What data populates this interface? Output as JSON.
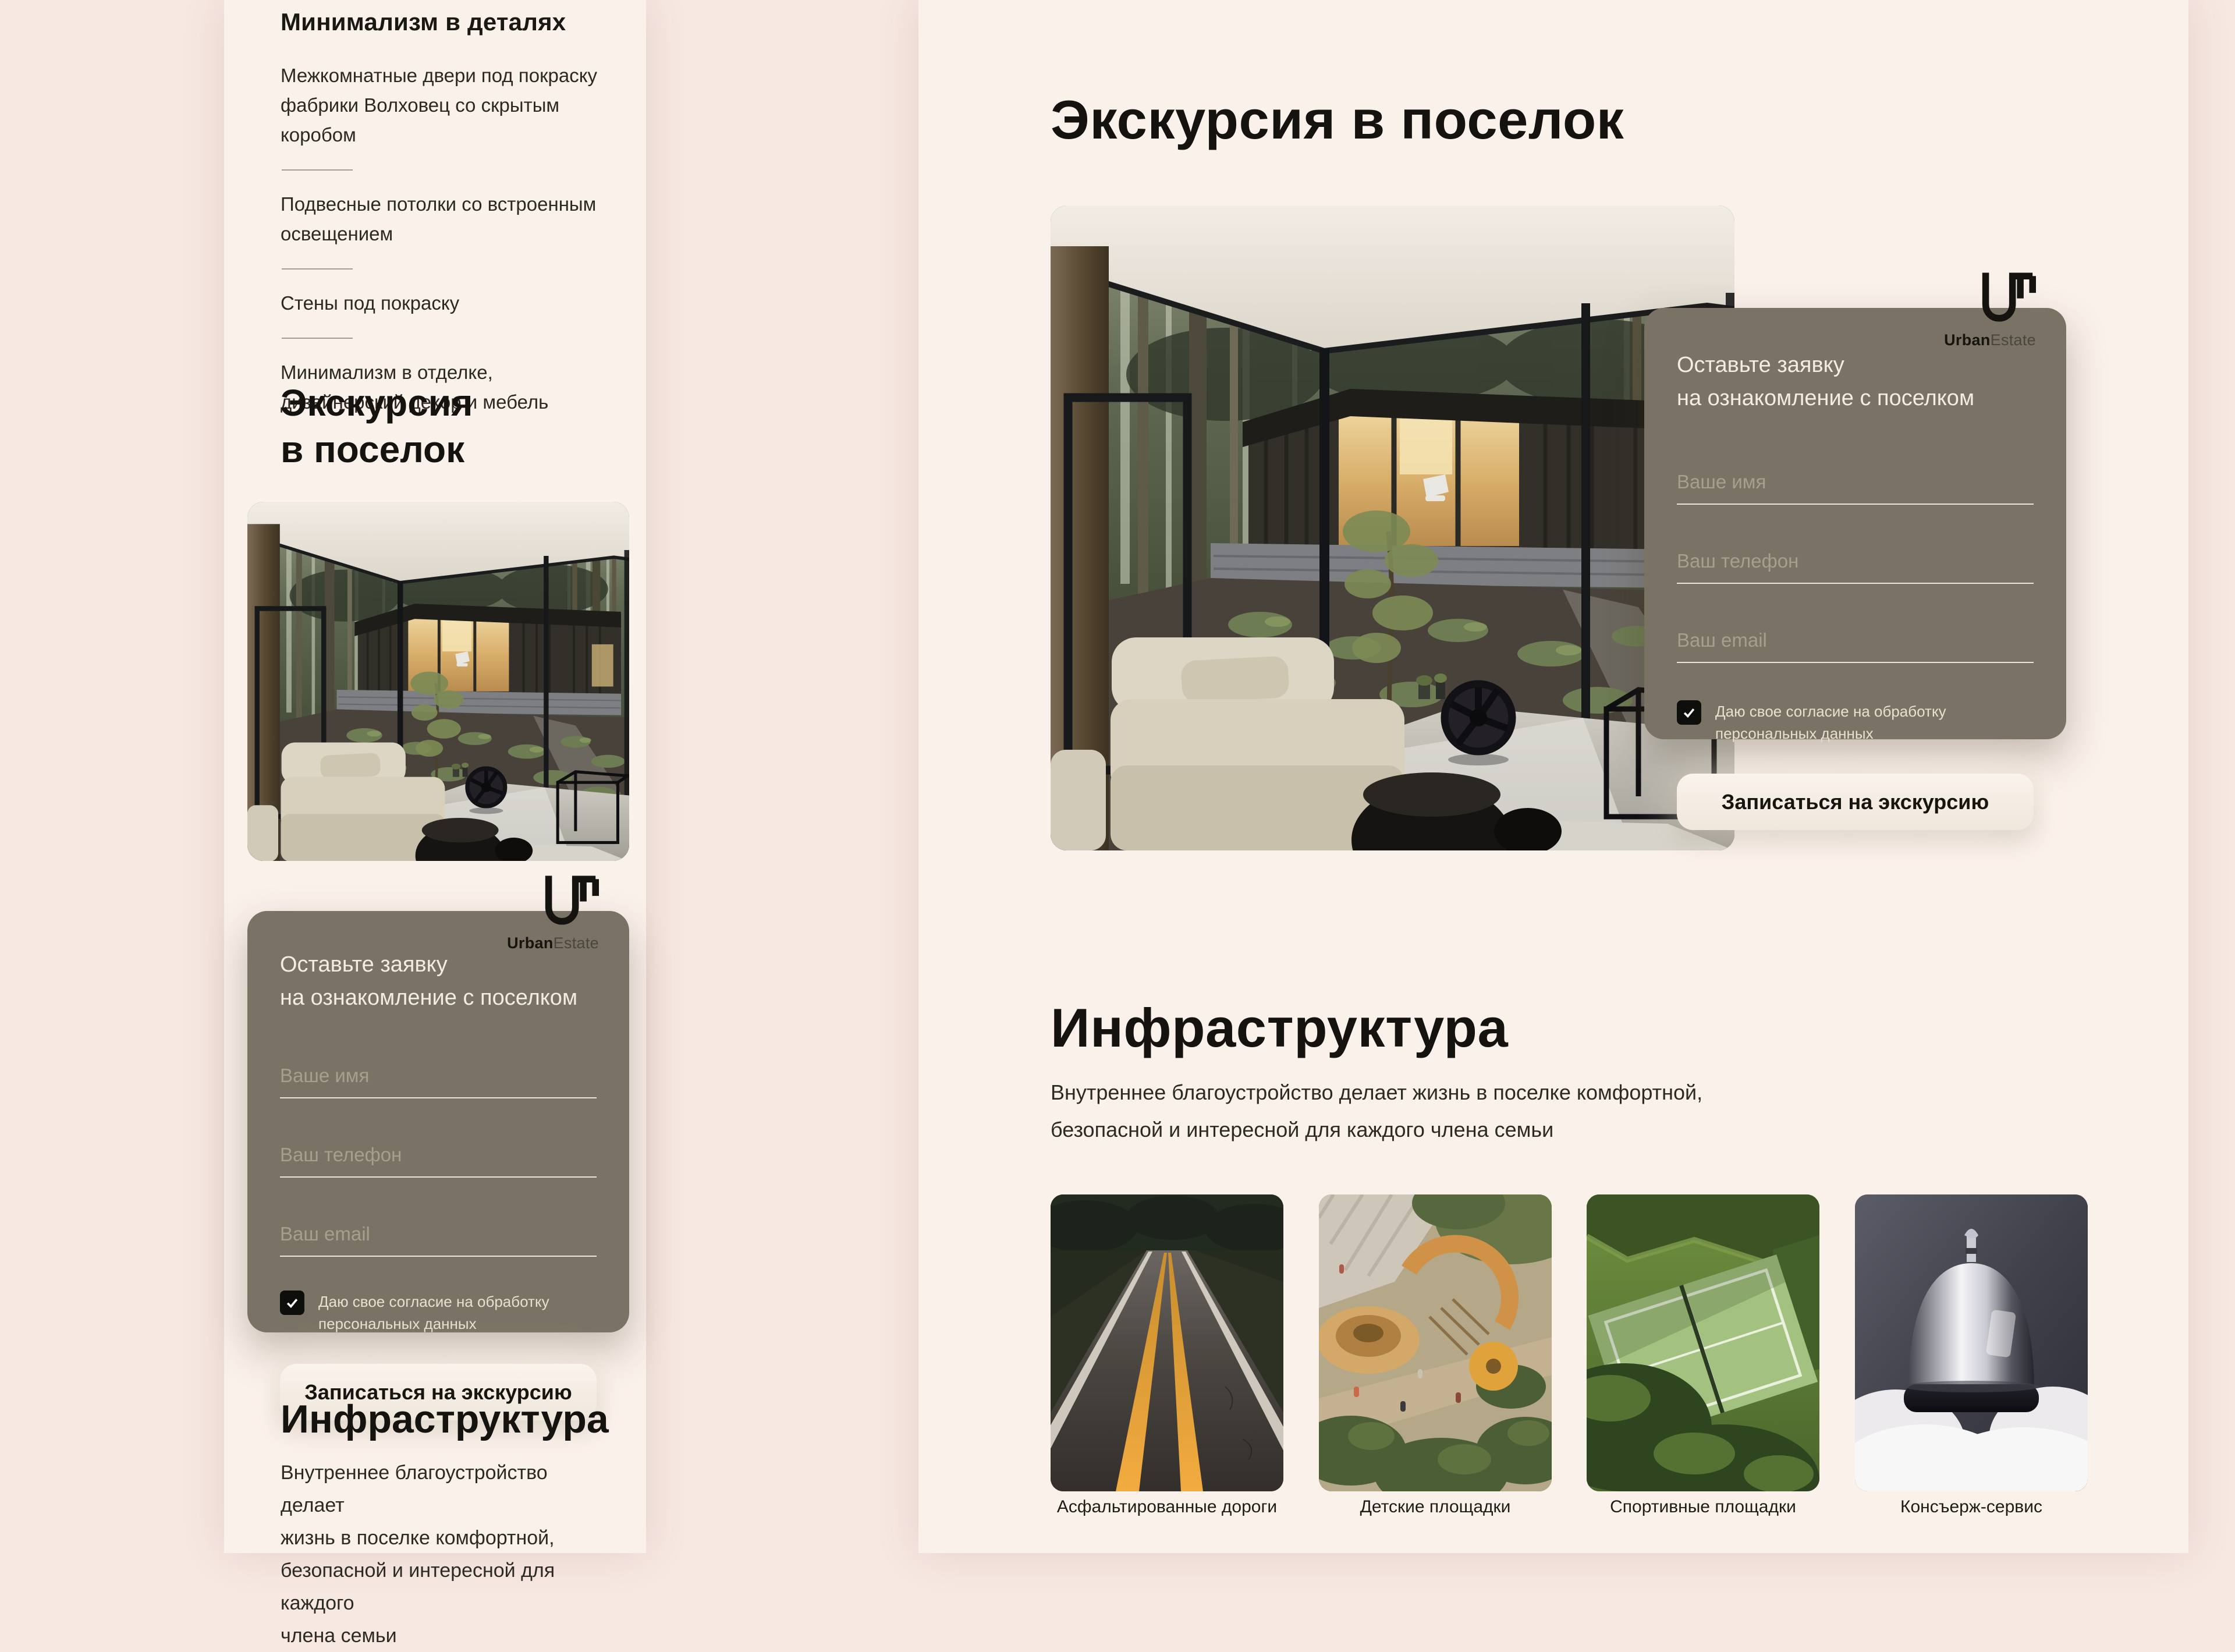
{
  "brand": {
    "name_bold": "Urban",
    "name_light": "Estate"
  },
  "colors": {
    "page_bg": "#f7e8e2",
    "board_bg": "#fbf1eb",
    "card_bg": "#7a7264",
    "card_text": "#f3ecdf",
    "button_bg": "#f6eee5",
    "button_text": "#16150f",
    "accent_yellow_line": "#e9a63d"
  },
  "details_section": {
    "heading": "Минимализм в деталях",
    "items": [
      "Межкомнатные двери под покраску фабрики Волховец со скрытым коробом",
      "Подвесные потолки со встроенным освещением",
      "Стены под покраску",
      "Минимализм в отделке, дизайнерский декор и мебель"
    ]
  },
  "tour_mobile": {
    "line1": "Экскурсия",
    "line2": "в поселок"
  },
  "tour_desktop": {
    "heading": "Экскурсия в поселок"
  },
  "form": {
    "title_line1": "Оставьте заявку",
    "title_line2": "на ознакомление с поселком",
    "name_placeholder": "Ваше имя",
    "phone_placeholder": "Ваш телефон",
    "email_placeholder": "Ваш email",
    "consent_line1": "Даю свое согласие на обработку",
    "consent_line2": "персональных данных",
    "consent_checked": true,
    "submit_label": "Записаться на экскурсию"
  },
  "infrastructure": {
    "heading": "Инфраструктура",
    "mobile_lines": [
      "Внутреннее благоустройство делает",
      "жизнь в поселке комфортной,",
      "безопасной и интересной для каждого",
      "члена семьи"
    ],
    "desktop_lines": [
      "Внутреннее благоустройство делает жизнь в поселке комфортной,",
      "безопасной и интересной для каждого члена семьи"
    ],
    "cards": [
      {
        "caption": "Асфальтированные дороги",
        "illustration": "asphalt-road"
      },
      {
        "caption": "Детские площадки",
        "illustration": "kids-playground"
      },
      {
        "caption": "Спортивные площадки",
        "illustration": "sports-courts"
      },
      {
        "caption": "Консъерж-сервис",
        "illustration": "concierge-bell"
      }
    ]
  }
}
